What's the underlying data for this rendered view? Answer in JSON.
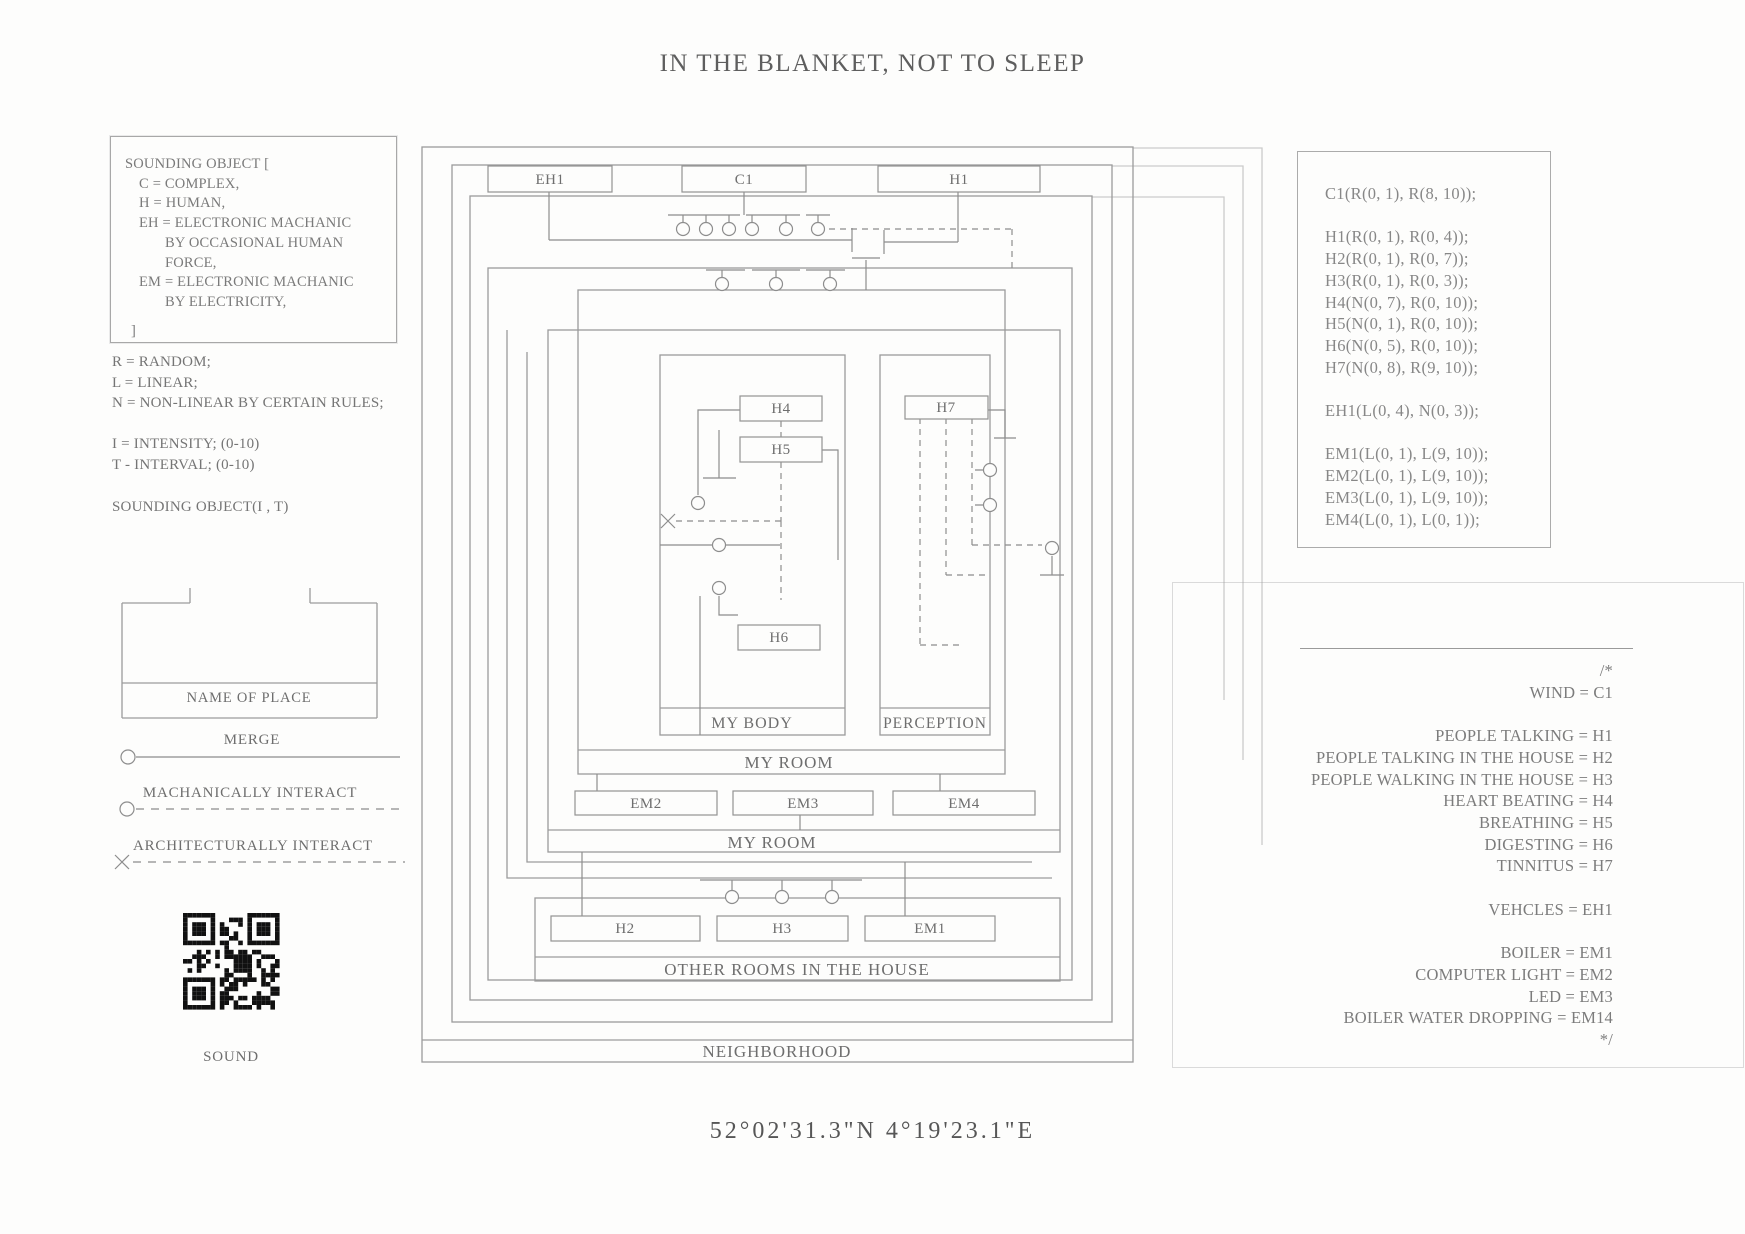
{
  "page": {
    "title": "IN THE BLANKET, NOT TO SLEEP",
    "coordinates": "52°02'31.3\"N 4°19'23.1\"E"
  },
  "colors": {
    "ink": "#8d8d8d",
    "text": "#6f6f6f",
    "qr": "#111111"
  },
  "legend": {
    "open": "SOUNDING OBJECT [",
    "c": "C = COMPLEX,",
    "h": "H = HUMAN,",
    "eh": "EH = ELECTRONIC MACHANIC",
    "eh2": "BY OCCASIONAL HUMAN FORCE,",
    "em": "EM = ELECTRONIC MACHANIC",
    "em2": "BY ELECTRICITY,",
    "close": "]"
  },
  "defs": {
    "r": "R = RANDOM;",
    "l": "L = LINEAR;",
    "n": "N = NON-LINEAR BY CERTAIN RULES;",
    "i": "I = INTENSITY; (0-10)",
    "t": "T - INTERVAL; (0-10)",
    "call": "SOUNDING OBJECT(I , T)"
  },
  "symbols": {
    "place": "NAME OF PLACE",
    "merge": "MERGE",
    "mechanically": "MACHANICALLY INTERACT",
    "architecturally": "ARCHITECTURALLY INTERACT",
    "qr_caption": "SOUND"
  },
  "diagram": {
    "labels": {
      "neighborhood": "NEIGHBORHOOD",
      "other_rooms": "OTHER ROOMS IN THE HOUSE",
      "my_room_outer": "MY ROOM",
      "my_room_inner": "MY ROOM",
      "my_body": "MY BODY",
      "perception": "PERCEPTION"
    },
    "nodes": {
      "eh1": "EH1",
      "c1": "C1",
      "h1": "H1",
      "h2": "H2",
      "h3": "H3",
      "h4": "H4",
      "h5": "H5",
      "h6": "H6",
      "h7": "H7",
      "em1": "EM1",
      "em2": "EM2",
      "em3": "EM3",
      "em4": "EM4"
    }
  },
  "code_panel": {
    "lines": [
      "C1(R(0, 1), R(8, 10));",
      "",
      "H1(R(0, 1), R(0, 4));",
      "H2(R(0, 1), R(0, 7));",
      "H3(R(0, 1), R(0, 3));",
      "H4(N(0, 7), R(0, 10));",
      "H5(N(0, 1), R(0, 10));",
      "H6(N(0, 5), R(0, 10));",
      "H7(N(0, 8), R(9, 10));",
      "",
      "EH1(L(0, 4), N(0, 3));",
      "",
      "EM1(L(0, 1), L(9, 10));",
      "EM2(L(0, 1), L(9, 10));",
      "EM3(L(0, 1), L(9, 10));",
      "EM4(L(0, 1), L(0, 1));"
    ]
  },
  "mapping_panel": {
    "comment_open": "/*",
    "comment_close": "*/",
    "lines": [
      "WIND = C1",
      "",
      "PEOPLE TALKING = H1",
      "PEOPLE TALKING IN THE HOUSE = H2",
      "PEOPLE WALKING IN THE HOUSE = H3",
      "HEART BEATING = H4",
      "BREATHING = H5",
      "DIGESTING = H6",
      "TINNITUS = H7",
      "",
      "VEHCLES = EH1",
      "",
      "BOILER = EM1",
      "COMPUTER LIGHT = EM2",
      "LED = EM3",
      "BOILER WATER DROPPING = EM14"
    ]
  }
}
